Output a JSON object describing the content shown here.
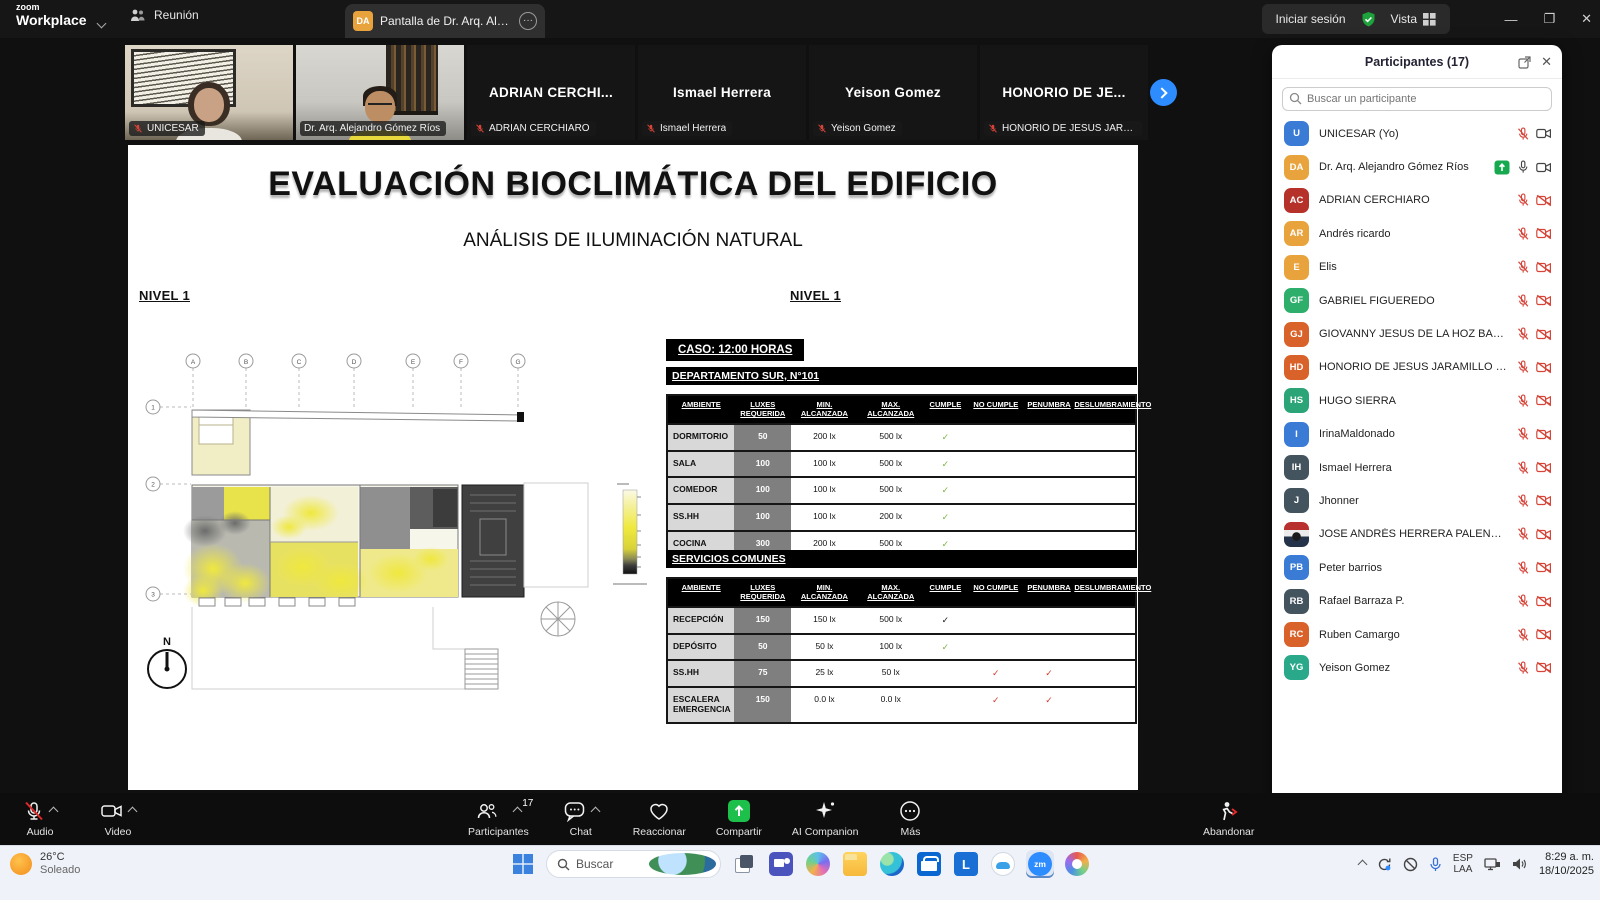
{
  "titlebar": {
    "logo_top": "zoom",
    "logo_bottom": "Workplace",
    "tab_meeting": "Reunión",
    "tab_screen": "Pantalla de Dr. Arq. Alejandro Gó",
    "tab_screen_avatar": "DA",
    "signin_label": "Iniciar sesión",
    "view_label": "Vista",
    "more_glyph": "···"
  },
  "video_strip": {
    "tiles": [
      {
        "style": "photo-unicesar",
        "display": "",
        "label": "UNICESAR",
        "muted": true,
        "active": false,
        "video": true
      },
      {
        "style": "photo-presenter",
        "display": "",
        "label": "Dr. Arq. Alejandro Gómez Ríos",
        "muted": false,
        "active": true,
        "video": true
      },
      {
        "style": "",
        "display": "ADRIAN CERCHI...",
        "label": "ADRIAN CERCHIARO",
        "muted": true,
        "active": false,
        "video": false
      },
      {
        "style": "",
        "display": "Ismael Herrera",
        "label": "Ismael Herrera",
        "muted": true,
        "active": false,
        "video": false
      },
      {
        "style": "",
        "display": "Yeison Gomez",
        "label": "Yeison Gomez",
        "muted": true,
        "active": false,
        "video": false
      },
      {
        "style": "",
        "display": "HONORIO DE JE...",
        "label": "HONORIO DE JESUS JARAMIL...",
        "muted": true,
        "active": false,
        "video": false
      }
    ]
  },
  "slide": {
    "title": "EVALUACIÓN BIOCLIMÁTICA DEL EDIFICIO",
    "subtitle": "ANÁLISIS DE ILUMINACIÓN NATURAL",
    "level_left": "NIVEL 1",
    "level_right": "NIVEL 1",
    "case_label": "CASO: 12:00 HORAS",
    "table1_title": "DEPARTAMENTO SUR, N°101",
    "table2_title": "SERVICIOS COMUNES",
    "compass_label": "N",
    "plan_grid_cols": [
      "A",
      "B",
      "C",
      "D",
      "E",
      "F",
      "G"
    ],
    "plan_grid_rows": [
      "1",
      "2",
      "3"
    ],
    "columns": [
      "AMBIENTE",
      "LUXES\nREQUERIDA",
      "MIN.\nALCANZADA",
      "MAX.\nALCANZADA",
      "CUMPLE",
      "NO CUMPLE",
      "PENUMBRA",
      "DESLUMBRAMIENTO"
    ],
    "check_colors": {
      "green": "#7cb342",
      "black": "#1a1a1a",
      "red": "#d23b2e"
    },
    "table1_rows": [
      {
        "ambiente": "DORMITORIO",
        "luxes": "50",
        "min": "200 lx",
        "max": "500 lx",
        "cumple": "green",
        "no_cumple": "",
        "penumbra": "",
        "deslumbramiento": ""
      },
      {
        "ambiente": "SALA",
        "luxes": "100",
        "min": "100 lx",
        "max": "500 lx",
        "cumple": "green",
        "no_cumple": "",
        "penumbra": "",
        "deslumbramiento": ""
      },
      {
        "ambiente": "COMEDOR",
        "luxes": "100",
        "min": "100 lx",
        "max": "500 lx",
        "cumple": "green",
        "no_cumple": "",
        "penumbra": "",
        "deslumbramiento": ""
      },
      {
        "ambiente": "SS.HH",
        "luxes": "100",
        "min": "100 lx",
        "max": "200 lx",
        "cumple": "green",
        "no_cumple": "",
        "penumbra": "",
        "deslumbramiento": ""
      },
      {
        "ambiente": "COCINA",
        "luxes": "300",
        "min": "200 lx",
        "max": "500 lx",
        "cumple": "green",
        "no_cumple": "",
        "penumbra": "",
        "deslumbramiento": ""
      }
    ],
    "table2_rows": [
      {
        "ambiente": "RECEPCIÓN",
        "luxes": "150",
        "min": "150 lx",
        "max": "500 lx",
        "cumple": "black",
        "no_cumple": "",
        "penumbra": "",
        "deslumbramiento": ""
      },
      {
        "ambiente": "DEPÓSITO",
        "luxes": "50",
        "min": "50 lx",
        "max": "100 lx",
        "cumple": "green",
        "no_cumple": "",
        "penumbra": "",
        "deslumbramiento": ""
      },
      {
        "ambiente": "SS.HH",
        "luxes": "75",
        "min": "25 lx",
        "max": "50 lx",
        "cumple": "",
        "no_cumple": "red",
        "penumbra": "red",
        "deslumbramiento": ""
      },
      {
        "ambiente": "ESCALERA\nEMERGENCIA",
        "luxes": "150",
        "min": "0.0 lx",
        "max": "0.0 lx",
        "cumple": "",
        "no_cumple": "red",
        "penumbra": "red",
        "deslumbramiento": ""
      }
    ]
  },
  "participants_panel": {
    "title": "Participantes (17)",
    "search_placeholder": "Buscar un participante",
    "list": [
      {
        "initials": "U",
        "color": "#3a7bd5",
        "name": "UNICESAR (Yo)",
        "sharing": false,
        "mic": "muted",
        "cam": "on"
      },
      {
        "initials": "DA",
        "color": "#e8a33d",
        "name": "Dr. Arq. Alejandro Gómez Ríos",
        "sharing": true,
        "mic": "on",
        "cam": "on"
      },
      {
        "initials": "AC",
        "color": "#b5312a",
        "name": "ADRIAN CERCHIARO",
        "sharing": false,
        "mic": "muted",
        "cam": "off"
      },
      {
        "initials": "AR",
        "color": "#e8a33d",
        "name": "Andrés ricardo",
        "sharing": false,
        "mic": "muted",
        "cam": "off"
      },
      {
        "initials": "E",
        "color": "#e8a33d",
        "name": "Elis",
        "sharing": false,
        "mic": "muted",
        "cam": "off"
      },
      {
        "initials": "GF",
        "color": "#2eae6b",
        "name": "GABRIEL FIGUEREDO",
        "sharing": false,
        "mic": "muted",
        "cam": "off"
      },
      {
        "initials": "GJ",
        "color": "#d9622b",
        "name": "GIOVANNY JESUS DE LA HOZ BARRIOS",
        "sharing": false,
        "mic": "muted",
        "cam": "off"
      },
      {
        "initials": "HD",
        "color": "#d9622b",
        "name": "HONORIO DE JESUS JARAMILLO ORT...",
        "sharing": false,
        "mic": "muted",
        "cam": "off"
      },
      {
        "initials": "HS",
        "color": "#2ba577",
        "name": "HUGO SIERRA",
        "sharing": false,
        "mic": "muted",
        "cam": "off"
      },
      {
        "initials": "I",
        "color": "#3a7bd5",
        "name": "IrinaMaldonado",
        "sharing": false,
        "mic": "muted",
        "cam": "off"
      },
      {
        "initials": "IH",
        "color": "#44545f",
        "name": "Ismael Herrera",
        "sharing": false,
        "mic": "muted",
        "cam": "off"
      },
      {
        "initials": "J",
        "color": "#44545f",
        "name": "Jhonner",
        "sharing": false,
        "mic": "muted",
        "cam": "off"
      },
      {
        "initials": "",
        "avatar": "img",
        "color": "",
        "name": "JOSE ANDRÉS HERRERA PALENCIA",
        "sharing": false,
        "mic": "muted",
        "cam": "off"
      },
      {
        "initials": "PB",
        "color": "#3a7bd5",
        "name": "Peter barrios",
        "sharing": false,
        "mic": "muted",
        "cam": "off"
      },
      {
        "initials": "RB",
        "color": "#44545f",
        "name": "Rafael Barraza P.",
        "sharing": false,
        "mic": "muted",
        "cam": "off"
      },
      {
        "initials": "RC",
        "color": "#d9622b",
        "name": "Ruben Camargo",
        "sharing": false,
        "mic": "muted",
        "cam": "off"
      },
      {
        "initials": "YG",
        "color": "#2aa88a",
        "name": "Yeison Gomez",
        "sharing": false,
        "mic": "muted",
        "cam": "off"
      }
    ],
    "buttons": [
      "Invitar",
      "Reactivar mi audio",
      "Reclamar anfitrión"
    ]
  },
  "toolbar": {
    "audio": "Audio",
    "video": "Video",
    "participants": "Participantes",
    "participants_count": "17",
    "chat": "Chat",
    "react": "Reaccionar",
    "share": "Compartir",
    "ai": "AI Companion",
    "more": "Más",
    "leave": "Abandonar",
    "share_green": "#1cc04a",
    "muted_red": "#e02828"
  },
  "taskbar": {
    "temp": "26°C",
    "weather_desc": "Soleado",
    "search_placeholder": "Buscar",
    "icons": [
      "task-view",
      "teams",
      "copilot",
      "file-explorer",
      "edge",
      "store",
      "l-app",
      "cloud-app",
      "zoom",
      "media-app"
    ],
    "zoom_label": "zm",
    "l_label": "L",
    "lang_top": "ESP",
    "lang_bottom": "LAA",
    "time": "8:29 a. m.",
    "date": "18/10/2025"
  }
}
